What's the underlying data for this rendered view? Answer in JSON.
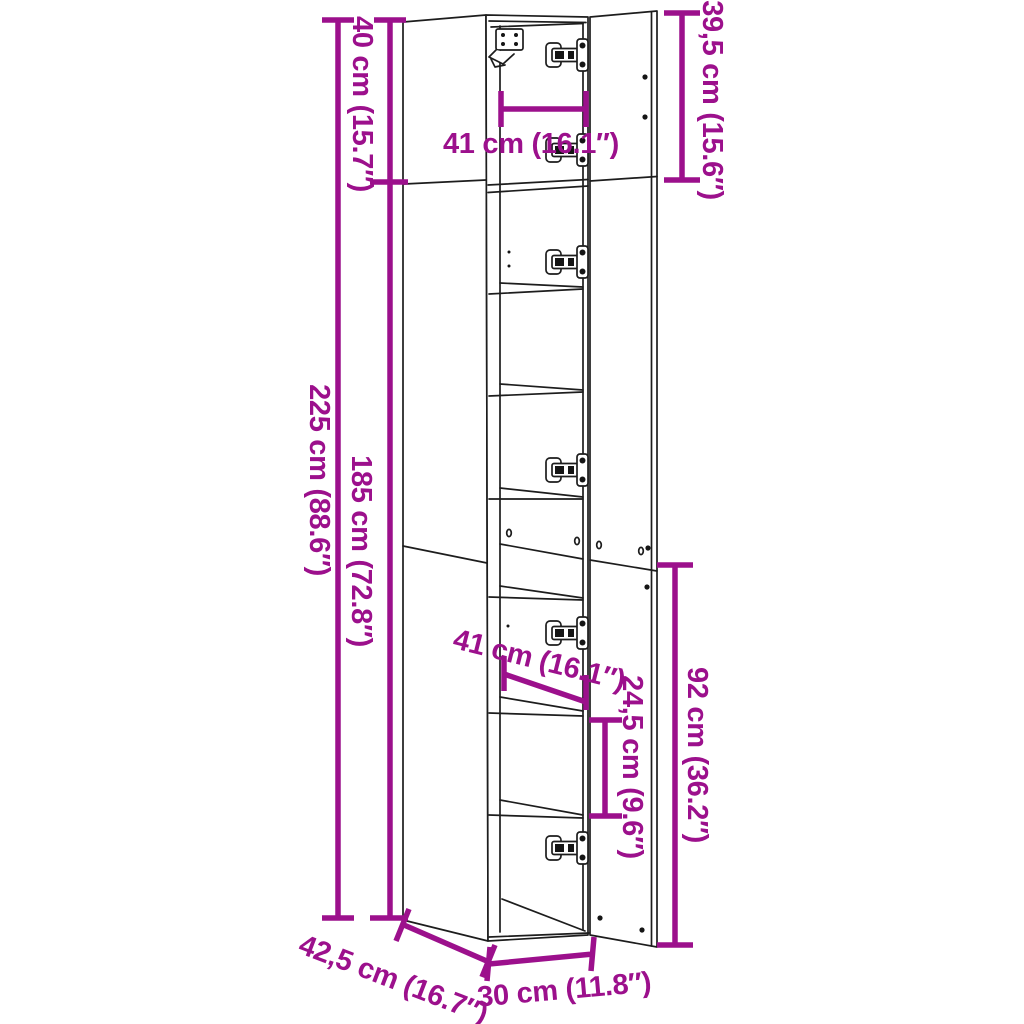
{
  "diagram": {
    "background": "#ffffff",
    "accent_color": "#9c108c",
    "line_color": "#1d1d1d",
    "labels": {
      "overall_height": "225 cm (88.6″)",
      "lower_section_height": "185 cm (72.8″)",
      "top_compartment_height": "40 cm (15.7″)",
      "top_door_height": "39,5 cm (15.6″)",
      "top_inner_width": "41 cm (16.1″)",
      "middle_inner_width": "41 cm (16.1″)",
      "shelf_spacing": "24,5 cm (9.6″)",
      "bottom_door_height": "92 cm (36.2″)",
      "depth": "42,5 cm (16.7″)",
      "width": "30 cm (11.8″)"
    }
  }
}
